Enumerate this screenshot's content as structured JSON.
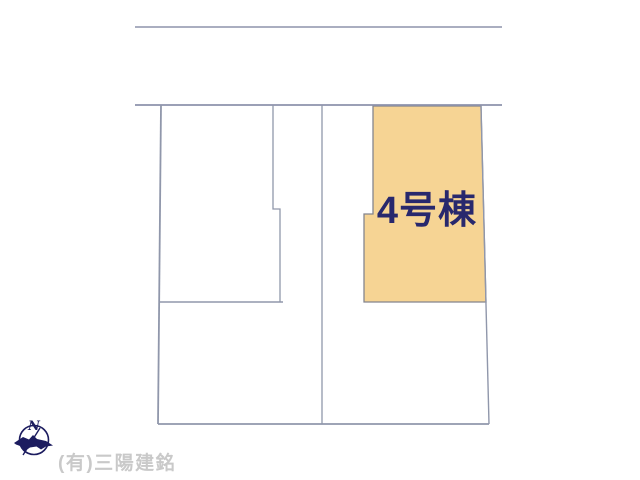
{
  "plan": {
    "highlighted_lot": {
      "label": "4号棟"
    },
    "colors": {
      "highlight_fill": "#f6d494",
      "highlight_border": "#84858e",
      "boundary_line": "#9097ab",
      "label_text": "#28286d"
    }
  },
  "footer": {
    "compass": {
      "label": "N"
    },
    "company": "(有)三陽建銘",
    "colors": {
      "compass": "#1c1c5f",
      "company_text": "#c9c9c9"
    }
  }
}
